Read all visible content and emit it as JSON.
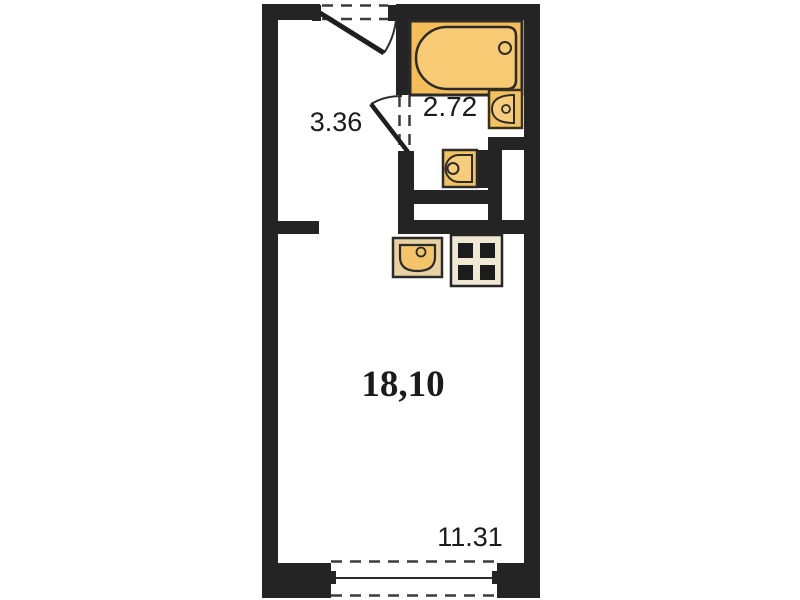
{
  "plan": {
    "title": "studio-apartment-floor-plan",
    "rooms": [
      {
        "id": "hallway",
        "area_label": "3.36"
      },
      {
        "id": "bathroom",
        "area_label": "2.72"
      },
      {
        "id": "main-room",
        "area_label": "18,10"
      },
      {
        "id": "window-zone",
        "area_label": "11.31"
      }
    ],
    "fixtures": [
      {
        "id": "bathtub"
      },
      {
        "id": "bathroom-sink"
      },
      {
        "id": "washing-machine"
      },
      {
        "id": "kitchen-sink"
      },
      {
        "id": "stove-4-burner"
      },
      {
        "id": "entrance-door"
      },
      {
        "id": "bathroom-door"
      },
      {
        "id": "window"
      }
    ],
    "colors": {
      "wall": "#242424",
      "dash": "#3c3c3c",
      "fixture_amber": "#f4bd5a",
      "fixture_amber_light": "#f8ca74",
      "sink_square": "#f2c161",
      "kitchen_sink_base": "#e9d2a2",
      "kitchen_sink_bowl": "#f3c468",
      "stove_frame": "#f0e8d3",
      "burner": "#1c1c1c",
      "background": "#ffffff",
      "text": "#1b1b1b"
    }
  }
}
